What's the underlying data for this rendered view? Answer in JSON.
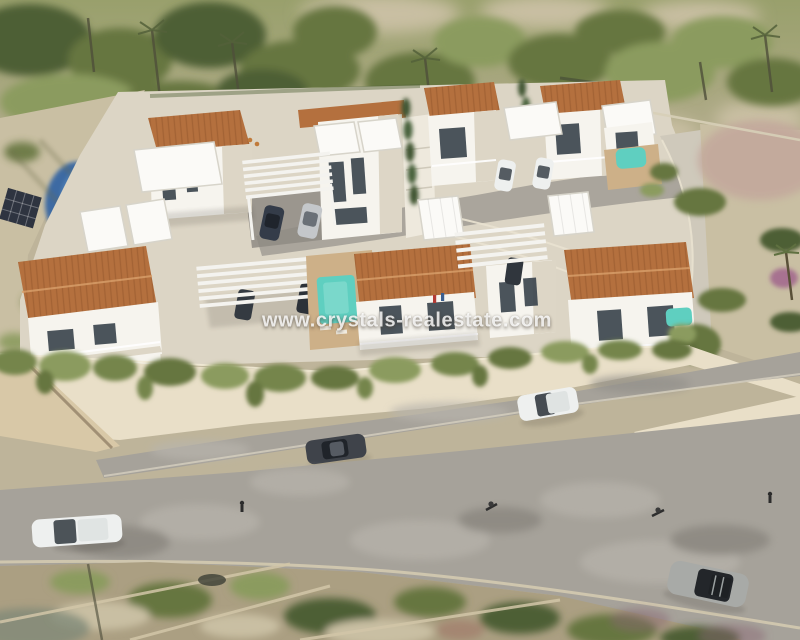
{
  "watermark": {
    "text": "www.crystals-realestate.com"
  },
  "scene": {
    "type": "aerial-architectural-render",
    "setting": "new-build villa development with white modern houses, terracotta roofs, private pools, pergola carports, curving access roads and Mediterranean scrubland",
    "villas_terracotta_roof": 7,
    "pools_visible": 4,
    "vehicles_visible": 11
  },
  "colors": {
    "terracotta": "#b4703e",
    "terracotta_dark": "#96582f",
    "villa_white": "#f6f4ee",
    "villa_shade": "#ddd6c6",
    "flat_roof": "#fbfaf7",
    "flat_roof_edge": "#d7d4ca",
    "glass": "#3c454e",
    "plot": "#dcd5c5",
    "road_gray": "#a6a29a",
    "road_light": "#cfc9bb",
    "road_dark": "#8f8b84",
    "wall_cream": "#e9dfc8",
    "wall_shade": "#d8c8a7",
    "hedge": "#74854b",
    "veg_dark": "#4e5f35",
    "veg_mid": "#66763f",
    "veg_light": "#8b9b5e",
    "sand": "#beb49a",
    "sand_light": "#c9bfa3",
    "scrub": "#ab9f82",
    "pool": "#5fcfc0",
    "neighbor_pool": "#3d6ba3",
    "deck": "#cdb088",
    "car_dark": "#3f434a",
    "car_white": "#eef0ef",
    "car_silver": "#c4c7ca",
    "car_gray": "#a8aaa7",
    "watermark": "rgba(255,255,255,0.82)"
  }
}
